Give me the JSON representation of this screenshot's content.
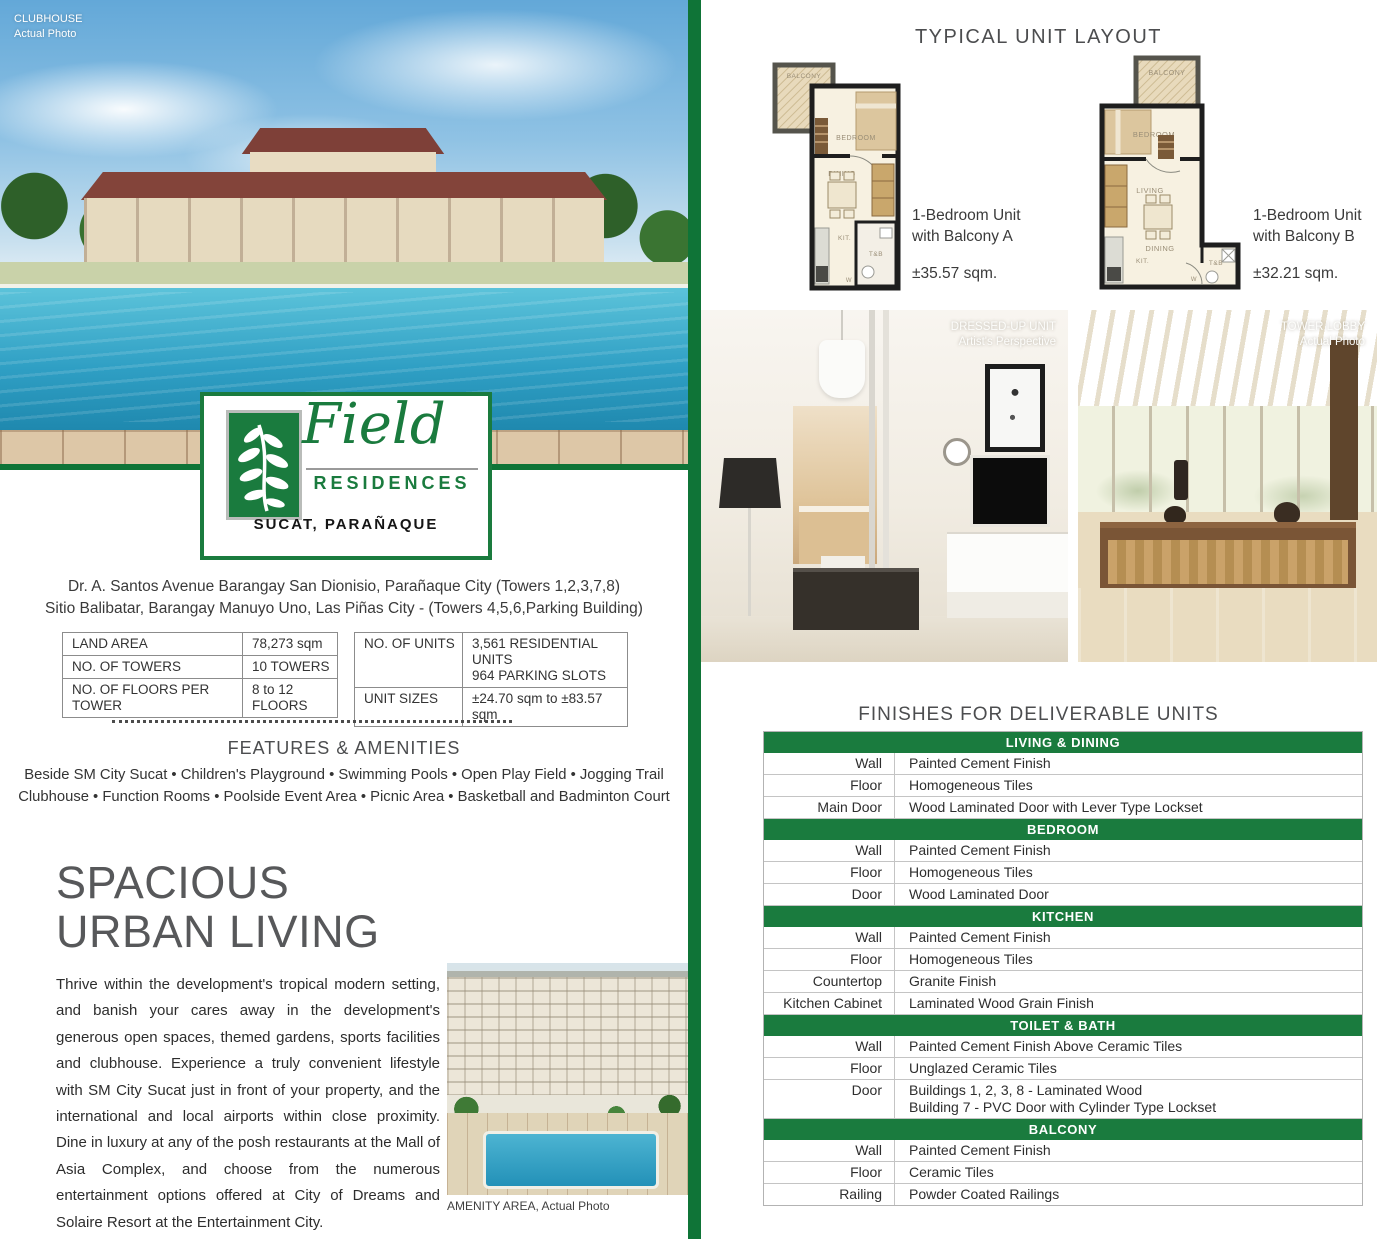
{
  "colors": {
    "brand_green": "#1a7b3e",
    "divider_green": "#0f7437",
    "heading_gray": "#4c4d4f"
  },
  "left": {
    "clubhouse_photo": {
      "caption_line1": "CLUBHOUSE",
      "caption_line2": "Actual Photo"
    },
    "logo": {
      "name": "Field",
      "subname": "RESIDENCES",
      "location": "SUCAT, PARAÑAQUE"
    },
    "address_line1": "Dr. A. Santos Avenue Barangay San Dionisio, Parañaque City (Towers 1,2,3,7,8)",
    "address_line2": "Sitio Balibatar, Barangay Manuyo Uno, Las Piñas City - (Towers 4,5,6,Parking Building)",
    "spec_table_left": {
      "rows": [
        {
          "label": "LAND AREA",
          "value_lines": [
            "78,273 sqm"
          ]
        },
        {
          "label": "NO. OF TOWERS",
          "value_lines": [
            "10 TOWERS"
          ]
        },
        {
          "label": "NO. OF FLOORS PER TOWER",
          "value_lines": [
            "8 to 12 FLOORS"
          ]
        }
      ]
    },
    "spec_table_right": {
      "rows": [
        {
          "label": "NO. OF UNITS",
          "value_lines": [
            "3,561 RESIDENTIAL UNITS",
            "964 PARKING SLOTS"
          ]
        },
        {
          "label": "UNIT SIZES",
          "value_lines": [
            "±24.70 sqm to ±83.57 sqm"
          ]
        }
      ]
    },
    "features": {
      "title": "FEATURES & AMENITIES",
      "line1": "Beside SM City Sucat • Children's Playground • Swimming Pools • Open Play Field • Jogging Trail",
      "line2": "Clubhouse • Function Rooms • Poolside Event Area • Picnic Area • Basketball and Badminton Court"
    },
    "headline_line1": "SPACIOUS",
    "headline_line2": "URBAN LIVING",
    "body_text": "Thrive within the development's tropical modern setting, and banish your cares away in the development's generous open spaces, themed gardens, sports facilities and clubhouse. Experience a truly convenient lifestyle with SM City Sucat just in front of your property, and the international and local airports within close proximity. Dine in luxury at any of the posh restaurants at the Mall of Asia Complex, and choose from the numerous entertainment options offered at City of Dreams and Solaire Resort at the Entertainment City.",
    "amenity_photo_caption": "AMENITY AREA, Actual Photo"
  },
  "right": {
    "unit_layout_title": "TYPICAL UNIT LAYOUT",
    "units": [
      {
        "name_line1": "1-Bedroom Unit",
        "name_line2": "with Balcony A",
        "area": "±35.57 sqm."
      },
      {
        "name_line1": "1-Bedroom Unit",
        "name_line2": "with Balcony B",
        "area": "±32.21 sqm."
      }
    ],
    "floorplan_labels": {
      "balcony": "BALCONY",
      "bedroom": "BEDROOM",
      "living": "LIVING",
      "dining": "DINING",
      "kitchen": "KIT.",
      "toilet_bath": "T&B",
      "washer": "W"
    },
    "photos": [
      {
        "label_line1": "DRESSED-UP UNIT",
        "label_line2": "Artist's Perspective"
      },
      {
        "label_line1": "TOWER LOBBY",
        "label_line2": "Actual Photo"
      }
    ],
    "finishes": {
      "title": "FINISHES FOR DELIVERABLE UNITS",
      "sections": [
        {
          "name": "LIVING & DINING",
          "rows": [
            {
              "label": "Wall",
              "value_lines": [
                "Painted Cement Finish"
              ]
            },
            {
              "label": "Floor",
              "value_lines": [
                "Homogeneous Tiles"
              ]
            },
            {
              "label": "Main Door",
              "value_lines": [
                "Wood Laminated Door with Lever Type Lockset"
              ]
            }
          ]
        },
        {
          "name": "BEDROOM",
          "rows": [
            {
              "label": "Wall",
              "value_lines": [
                "Painted Cement Finish"
              ]
            },
            {
              "label": "Floor",
              "value_lines": [
                "Homogeneous Tiles"
              ]
            },
            {
              "label": "Door",
              "value_lines": [
                "Wood Laminated Door"
              ]
            }
          ]
        },
        {
          "name": "KITCHEN",
          "rows": [
            {
              "label": "Wall",
              "value_lines": [
                "Painted Cement Finish"
              ]
            },
            {
              "label": "Floor",
              "value_lines": [
                "Homogeneous Tiles"
              ]
            },
            {
              "label": "Countertop",
              "value_lines": [
                "Granite Finish"
              ]
            },
            {
              "label": "Kitchen Cabinet",
              "value_lines": [
                "Laminated Wood Grain Finish"
              ]
            }
          ]
        },
        {
          "name": "TOILET & BATH",
          "rows": [
            {
              "label": "Wall",
              "value_lines": [
                "Painted Cement Finish Above Ceramic Tiles"
              ]
            },
            {
              "label": "Floor",
              "value_lines": [
                "Unglazed Ceramic Tiles"
              ]
            },
            {
              "label": "Door",
              "value_lines": [
                "Buildings 1, 2, 3, 8 - Laminated Wood",
                "Building 7 - PVC Door with Cylinder Type Lockset"
              ]
            }
          ]
        },
        {
          "name": "BALCONY",
          "rows": [
            {
              "label": "Wall",
              "value_lines": [
                "Painted Cement Finish"
              ]
            },
            {
              "label": "Floor",
              "value_lines": [
                "Ceramic Tiles"
              ]
            },
            {
              "label": "Railing",
              "value_lines": [
                "Powder Coated Railings"
              ]
            }
          ]
        }
      ]
    }
  }
}
